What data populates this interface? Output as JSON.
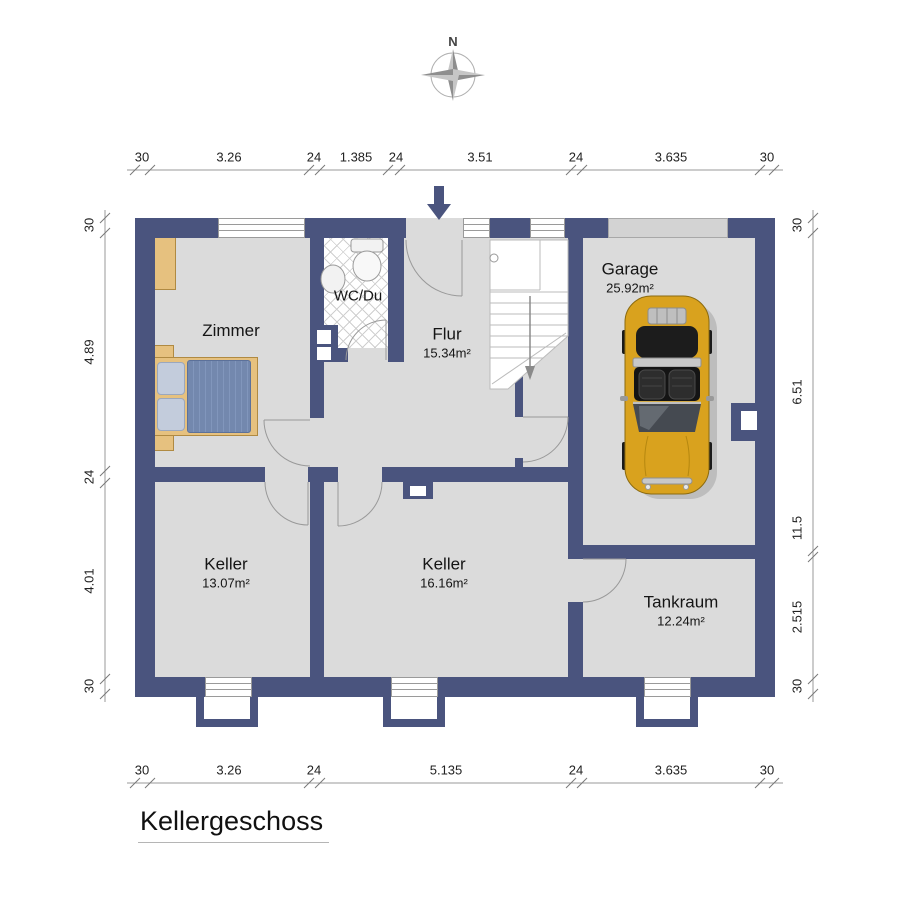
{
  "title": "Kellergeschoss",
  "compass": {
    "north_label": "N"
  },
  "rooms": {
    "zimmer": {
      "name": "Zimmer"
    },
    "wc": {
      "name": "WC/Du"
    },
    "flur": {
      "name": "Flur",
      "area": "15.34m²"
    },
    "garage": {
      "name": "Garage",
      "area": "25.92m²"
    },
    "keller1": {
      "name": "Keller",
      "area": "13.07m²"
    },
    "keller2": {
      "name": "Keller",
      "area": "16.16m²"
    },
    "tankraum": {
      "name": "Tankraum",
      "area": "12.24m²"
    }
  },
  "dimensions": {
    "top": [
      "30",
      "3.26",
      "24",
      "1.385",
      "24",
      "3.51",
      "24",
      "3.635",
      "30"
    ],
    "bottom": [
      "30",
      "3.26",
      "24",
      "5.135",
      "24",
      "3.635",
      "30"
    ],
    "left": [
      "30",
      "4.89",
      "24",
      "4.01",
      "30"
    ],
    "right": [
      "30",
      "6.51",
      "11.5",
      "2.515",
      "30"
    ]
  },
  "colors": {
    "wall": "#4A547E",
    "floor": "#DBDBDB",
    "car": "#D9A21E"
  }
}
